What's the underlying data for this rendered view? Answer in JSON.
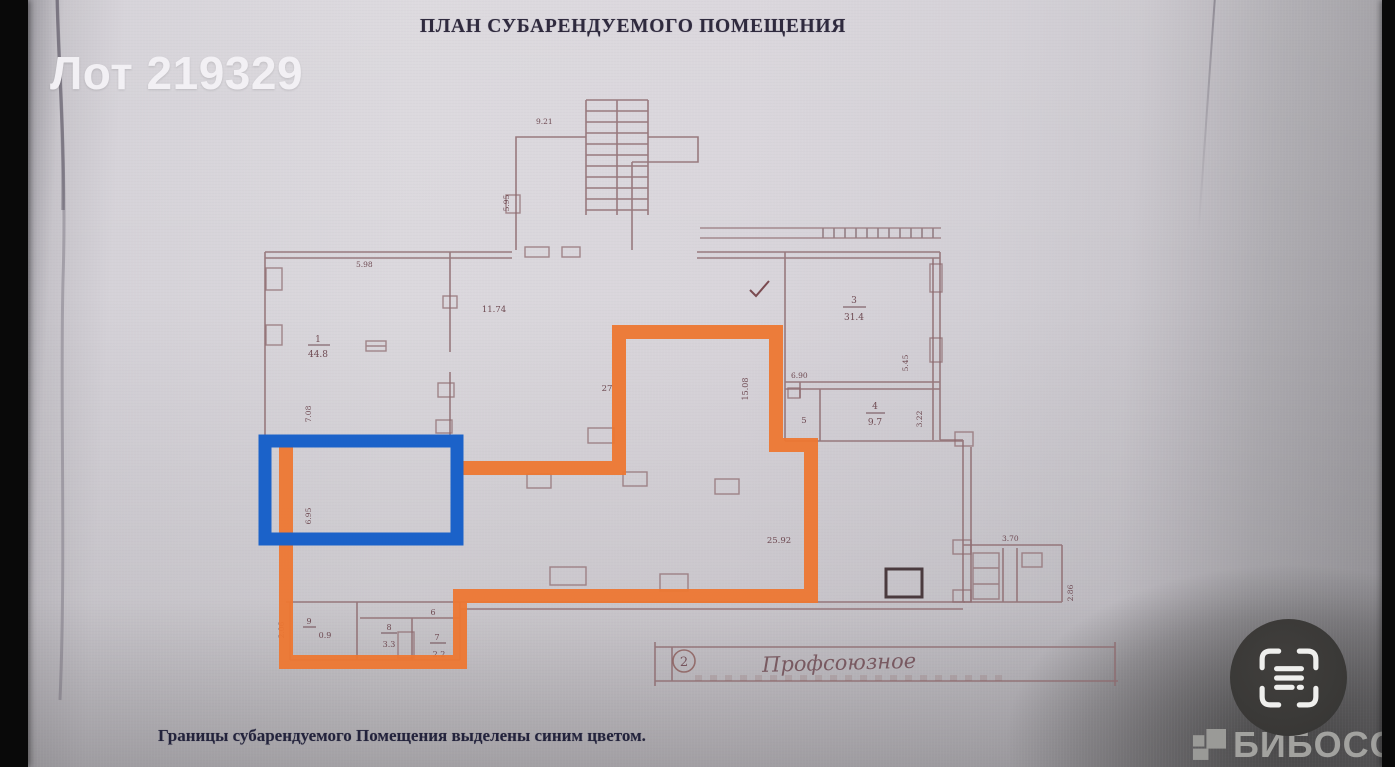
{
  "overlay": {
    "lot_label": "Лот 219329"
  },
  "document": {
    "title": "ПЛАН СУБАРЕНДУЕМОГО ПОМЕЩЕНИЯ",
    "caption": "Границы субарендуемого Помещения выделены синим цветом."
  },
  "plan": {
    "labels": {
      "stair_width": "9.21",
      "stair_height": "5.95",
      "room1_width": "5.98",
      "room1_number": "1",
      "room1_area": "44.8",
      "room1_height": "7.08",
      "hall_width": "11.74",
      "dim_27": "27",
      "dim_15_08": "15.08",
      "room3_number": "3",
      "room3_area": "31.4",
      "room3_height": "5.45",
      "dim_6_90": "6.90",
      "room4_number": "4",
      "room4_area": "9.7",
      "room4_height": "3.22",
      "room5_number": "5",
      "hall_area": "25.92",
      "annex_width": "3.70",
      "annex_height": "2.86",
      "blue_height": "6.95",
      "room9_number": "9",
      "room9_area": "0.9",
      "room8_number": "8",
      "room8_area": "3.3",
      "room7_number": "7",
      "room7_area": "2.2",
      "room6_number": "6",
      "ext_height": "2.06"
    },
    "street": {
      "number": "2",
      "name": "Профсоюзное"
    },
    "colors": {
      "sublease_outline": "#ed7732",
      "sublease_highlight": "#1b62c9",
      "drawing_line": "#8d6a6e"
    }
  },
  "watermark": {
    "brand": "БИБОСС"
  },
  "icons": {
    "scan": "scan-frame-icon",
    "brand_logo": "biboss-pixel-logo"
  }
}
